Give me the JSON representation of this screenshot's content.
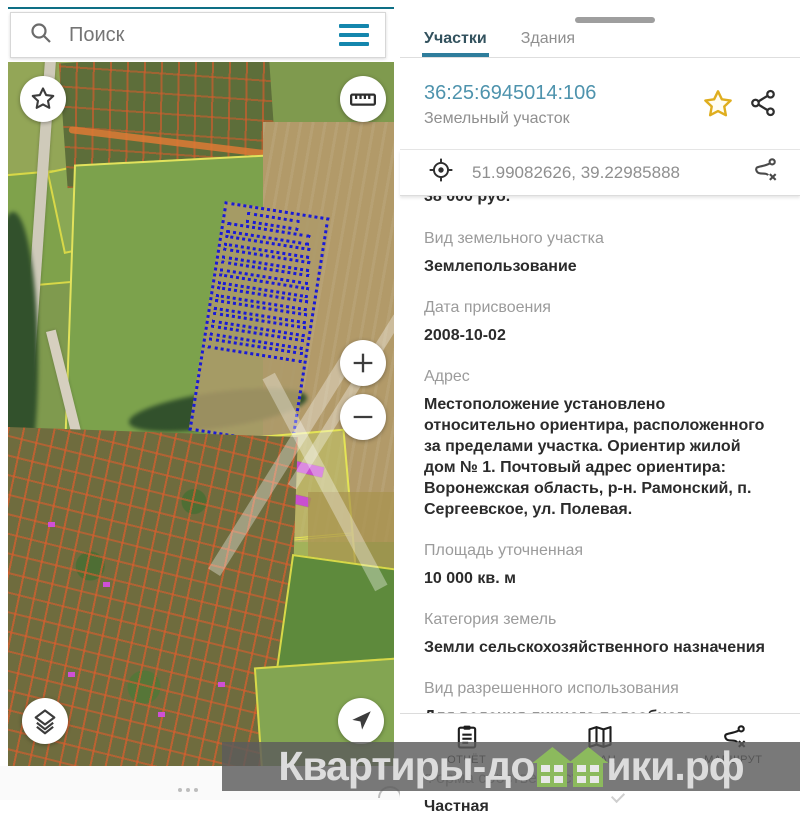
{
  "colors": {
    "accent_teal": "#1486ad",
    "tab_underline": "#2e7d9c",
    "parcel_id_blue": "#4e93ad",
    "label_gray": "#9b9b9b",
    "value_dark": "#2b2b2b",
    "star_gold": "#dfae1f",
    "watermark_green": "#8cba5d",
    "parcel_outline_orange": "#d65c2c",
    "parcel_outline_yellow": "#dede55",
    "selected_parcel_blue": "#1a1ad6"
  },
  "search": {
    "placeholder": "Поиск",
    "icons": [
      "search-icon",
      "menu-icon"
    ]
  },
  "map": {
    "controls": [
      "favorite-star-button",
      "ruler-button",
      "zoom-in-button",
      "zoom-out-button",
      "layers-button",
      "locate-button"
    ],
    "zoom_in": "+",
    "zoom_out": "−"
  },
  "panel": {
    "tabs": [
      {
        "label": "Участки",
        "active": true
      },
      {
        "label": "Здания",
        "active": false
      }
    ],
    "parcel_id": "36:25:6945014:106",
    "parcel_type": "Земельный участок",
    "header_icons": [
      "favorite-star-icon",
      "share-icon"
    ],
    "coordinates": "51.99082626, 39.22985888",
    "coordinate_icons": [
      "gps-target-icon",
      "route-clear-icon"
    ],
    "clipped_price": "38 000 руб.",
    "fields": [
      {
        "label": "Вид земельного участка",
        "value": "Землепользование"
      },
      {
        "label": "Дата присвоения",
        "value": "2008-10-02"
      },
      {
        "label": "Адрес",
        "value": "Местоположение установлено относительно ориентира, расположенного за пределами участка. Ориентир жилой дом № 1. Почтовый адрес ориентира: Воронежская область, р-н. Рамонский, п. Сергеевское, ул. Полевая."
      },
      {
        "label": "Площадь уточненная",
        "value": "10 000 кв. м"
      },
      {
        "label": "Категория земель",
        "value": "Земли сельскохозяйственного назначения"
      },
      {
        "label": "Вид разрешенного использования",
        "value": "Для ведения личного подсобного хозяйства"
      },
      {
        "label": "Форма собственности",
        "value": "Частная"
      }
    ]
  },
  "bottom_nav": [
    {
      "label": "ОТЧЁТ",
      "icon": "report-icon"
    },
    {
      "label": "ПЛАН",
      "icon": "plan-icon"
    },
    {
      "label": "МАРШРУТ",
      "icon": "route-icon"
    }
  ],
  "watermark": {
    "prefix": "Квартиры-до",
    "suffix": "ики.рф"
  }
}
